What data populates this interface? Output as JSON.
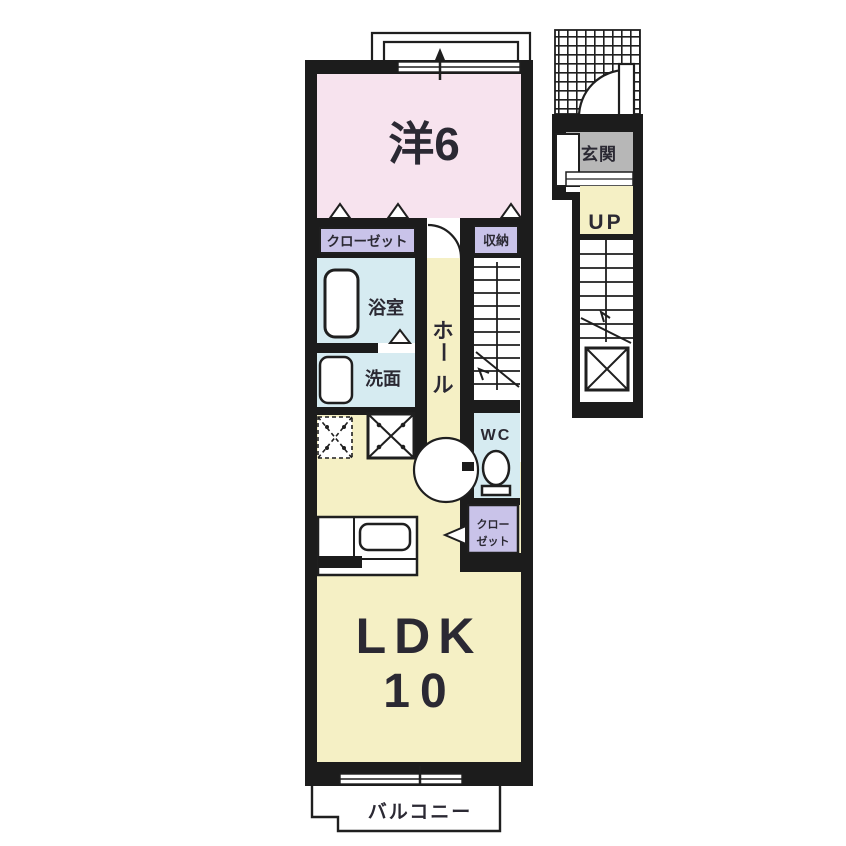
{
  "plan_type": "apartment-floor-plan-2F",
  "colors": {
    "wall": "#1c1c1c",
    "pink": "#f7e3ee",
    "yellow": "#f5f0c5",
    "lavender": "#c9c3e9",
    "blue": "#d6ebf1",
    "gray": "#b7b7b7",
    "line": "#1f1f1f",
    "bg": "#ffffff"
  },
  "rooms": {
    "western": {
      "label": "洋6"
    },
    "closet": {
      "label": "クローゼット"
    },
    "storage": {
      "label": "収納"
    },
    "bath": {
      "label": "浴室"
    },
    "washroom": {
      "label": "洗面"
    },
    "hall": {
      "char1": "ホ",
      "char2": "ー",
      "char3": "ル"
    },
    "wc": {
      "label": "WC"
    },
    "closet2": {
      "line1": "クロー",
      "line2": "ゼット"
    },
    "ldk": {
      "label": "LDK",
      "size": "10"
    },
    "balcony": {
      "label": "バルコニー"
    },
    "entrance": {
      "label": "玄関"
    },
    "up": {
      "label": "UP"
    }
  }
}
